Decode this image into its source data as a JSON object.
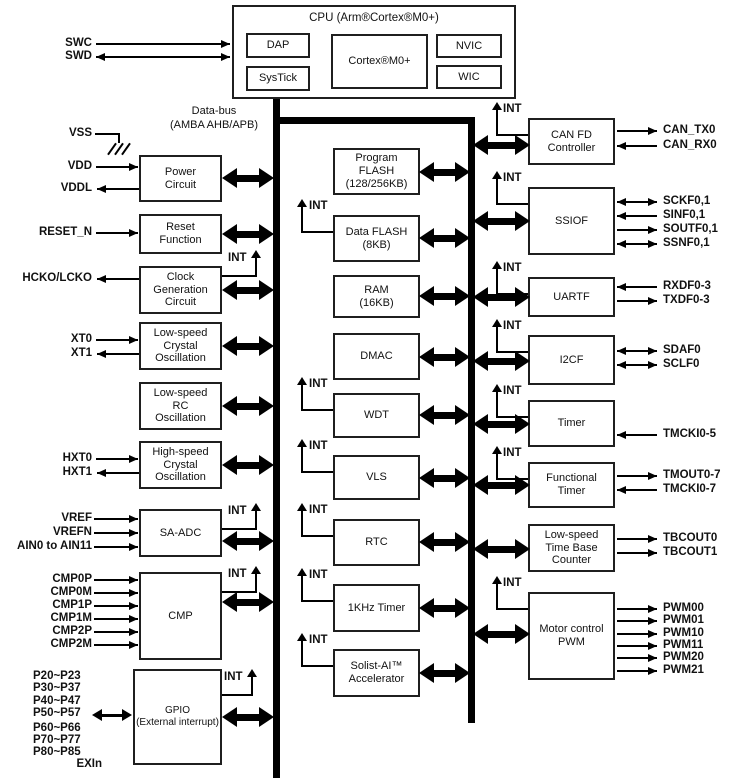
{
  "cpu": {
    "title": "CPU (Arm®Cortex®M0+)",
    "dap": "DAP",
    "systick": "SysTick",
    "core": "Cortex®M0+",
    "nvic": "NVIC",
    "wic": "WIC"
  },
  "bus": {
    "label": "Data-bus\n(AMBA AHB/APB)"
  },
  "int": "INT",
  "left_pins": {
    "swc": "SWC",
    "swd": "SWD",
    "vss": "VSS",
    "vdd": "VDD",
    "vddl": "VDDL",
    "reset": "RESET_N",
    "hcko": "HCKO/LCKO",
    "xt0": "XT0",
    "xt1": "XT1",
    "hxt0": "HXT0",
    "hxt1": "HXT1",
    "vref": "VREF",
    "vrefn": "VREFN",
    "ain": "AIN0 to AIN11",
    "cmp0p": "CMP0P",
    "cmp0m": "CMP0M",
    "cmp1p": "CMP1P",
    "cmp1m": "CMP1M",
    "cmp2p": "CMP2P",
    "cmp2m": "CMP2M",
    "p2": "P20~P23",
    "p3": "P30~P37",
    "p4": "P40~P47",
    "p5": "P50~P57",
    "p6": "P60~P66",
    "p7": "P70~P77",
    "p8": "P80~P85",
    "exin": "EXIn"
  },
  "left_blocks": {
    "power": "Power\nCircuit",
    "reset": "Reset\nFunction",
    "clock": "Clock\nGeneration\nCircuit",
    "lsxtal": "Low-speed\nCrystal\nOscillation",
    "lsrc": "Low-speed\nRC\nOscillation",
    "hsxtal": "High-speed\nCrystal\nOscillation",
    "saadc": "SA-ADC",
    "cmp": "CMP",
    "gpio": "GPIO\n(External interrupt)"
  },
  "mid_blocks": {
    "pflash": "Program\nFLASH\n(128/256KB)",
    "dflash": "Data FLASH\n(8KB)",
    "ram": "RAM\n(16KB)",
    "dmac": "DMAC",
    "wdt": "WDT",
    "vls": "VLS",
    "rtc": "RTC",
    "khz": "1KHz Timer",
    "solist": "Solist-AI™\nAccelerator"
  },
  "right_blocks": {
    "canfd": "CAN FD\nController",
    "ssiof": "SSIOF",
    "uartf": "UARTF",
    "i2cf": "I2CF",
    "timer": "Timer",
    "ftimer": "Functional\nTimer",
    "lstb": "Low-speed\nTime Base\nCounter",
    "mcpwm": "Motor control\nPWM"
  },
  "right_pins": {
    "cantx": "CAN_TX0",
    "canrx": "CAN_RX0",
    "sckf": "SCKF0,1",
    "sinf": "SINF0,1",
    "soutf": "SOUTF0,1",
    "ssnf": "SSNF0,1",
    "rxdf": "RXDF0-3",
    "txdf": "TXDF0-3",
    "sdaf": "SDAF0",
    "sclf": "SCLF0",
    "tmcki5": "TMCKI0-5",
    "tmout": "TMOUT0-7",
    "tmcki7": "TMCKI0-7",
    "tbcout0": "TBCOUT0",
    "tbcout1": "TBCOUT1",
    "pwm00": "PWM00",
    "pwm01": "PWM01",
    "pwm10": "PWM10",
    "pwm11": "PWM11",
    "pwm20": "PWM20",
    "pwm21": "PWM21"
  }
}
